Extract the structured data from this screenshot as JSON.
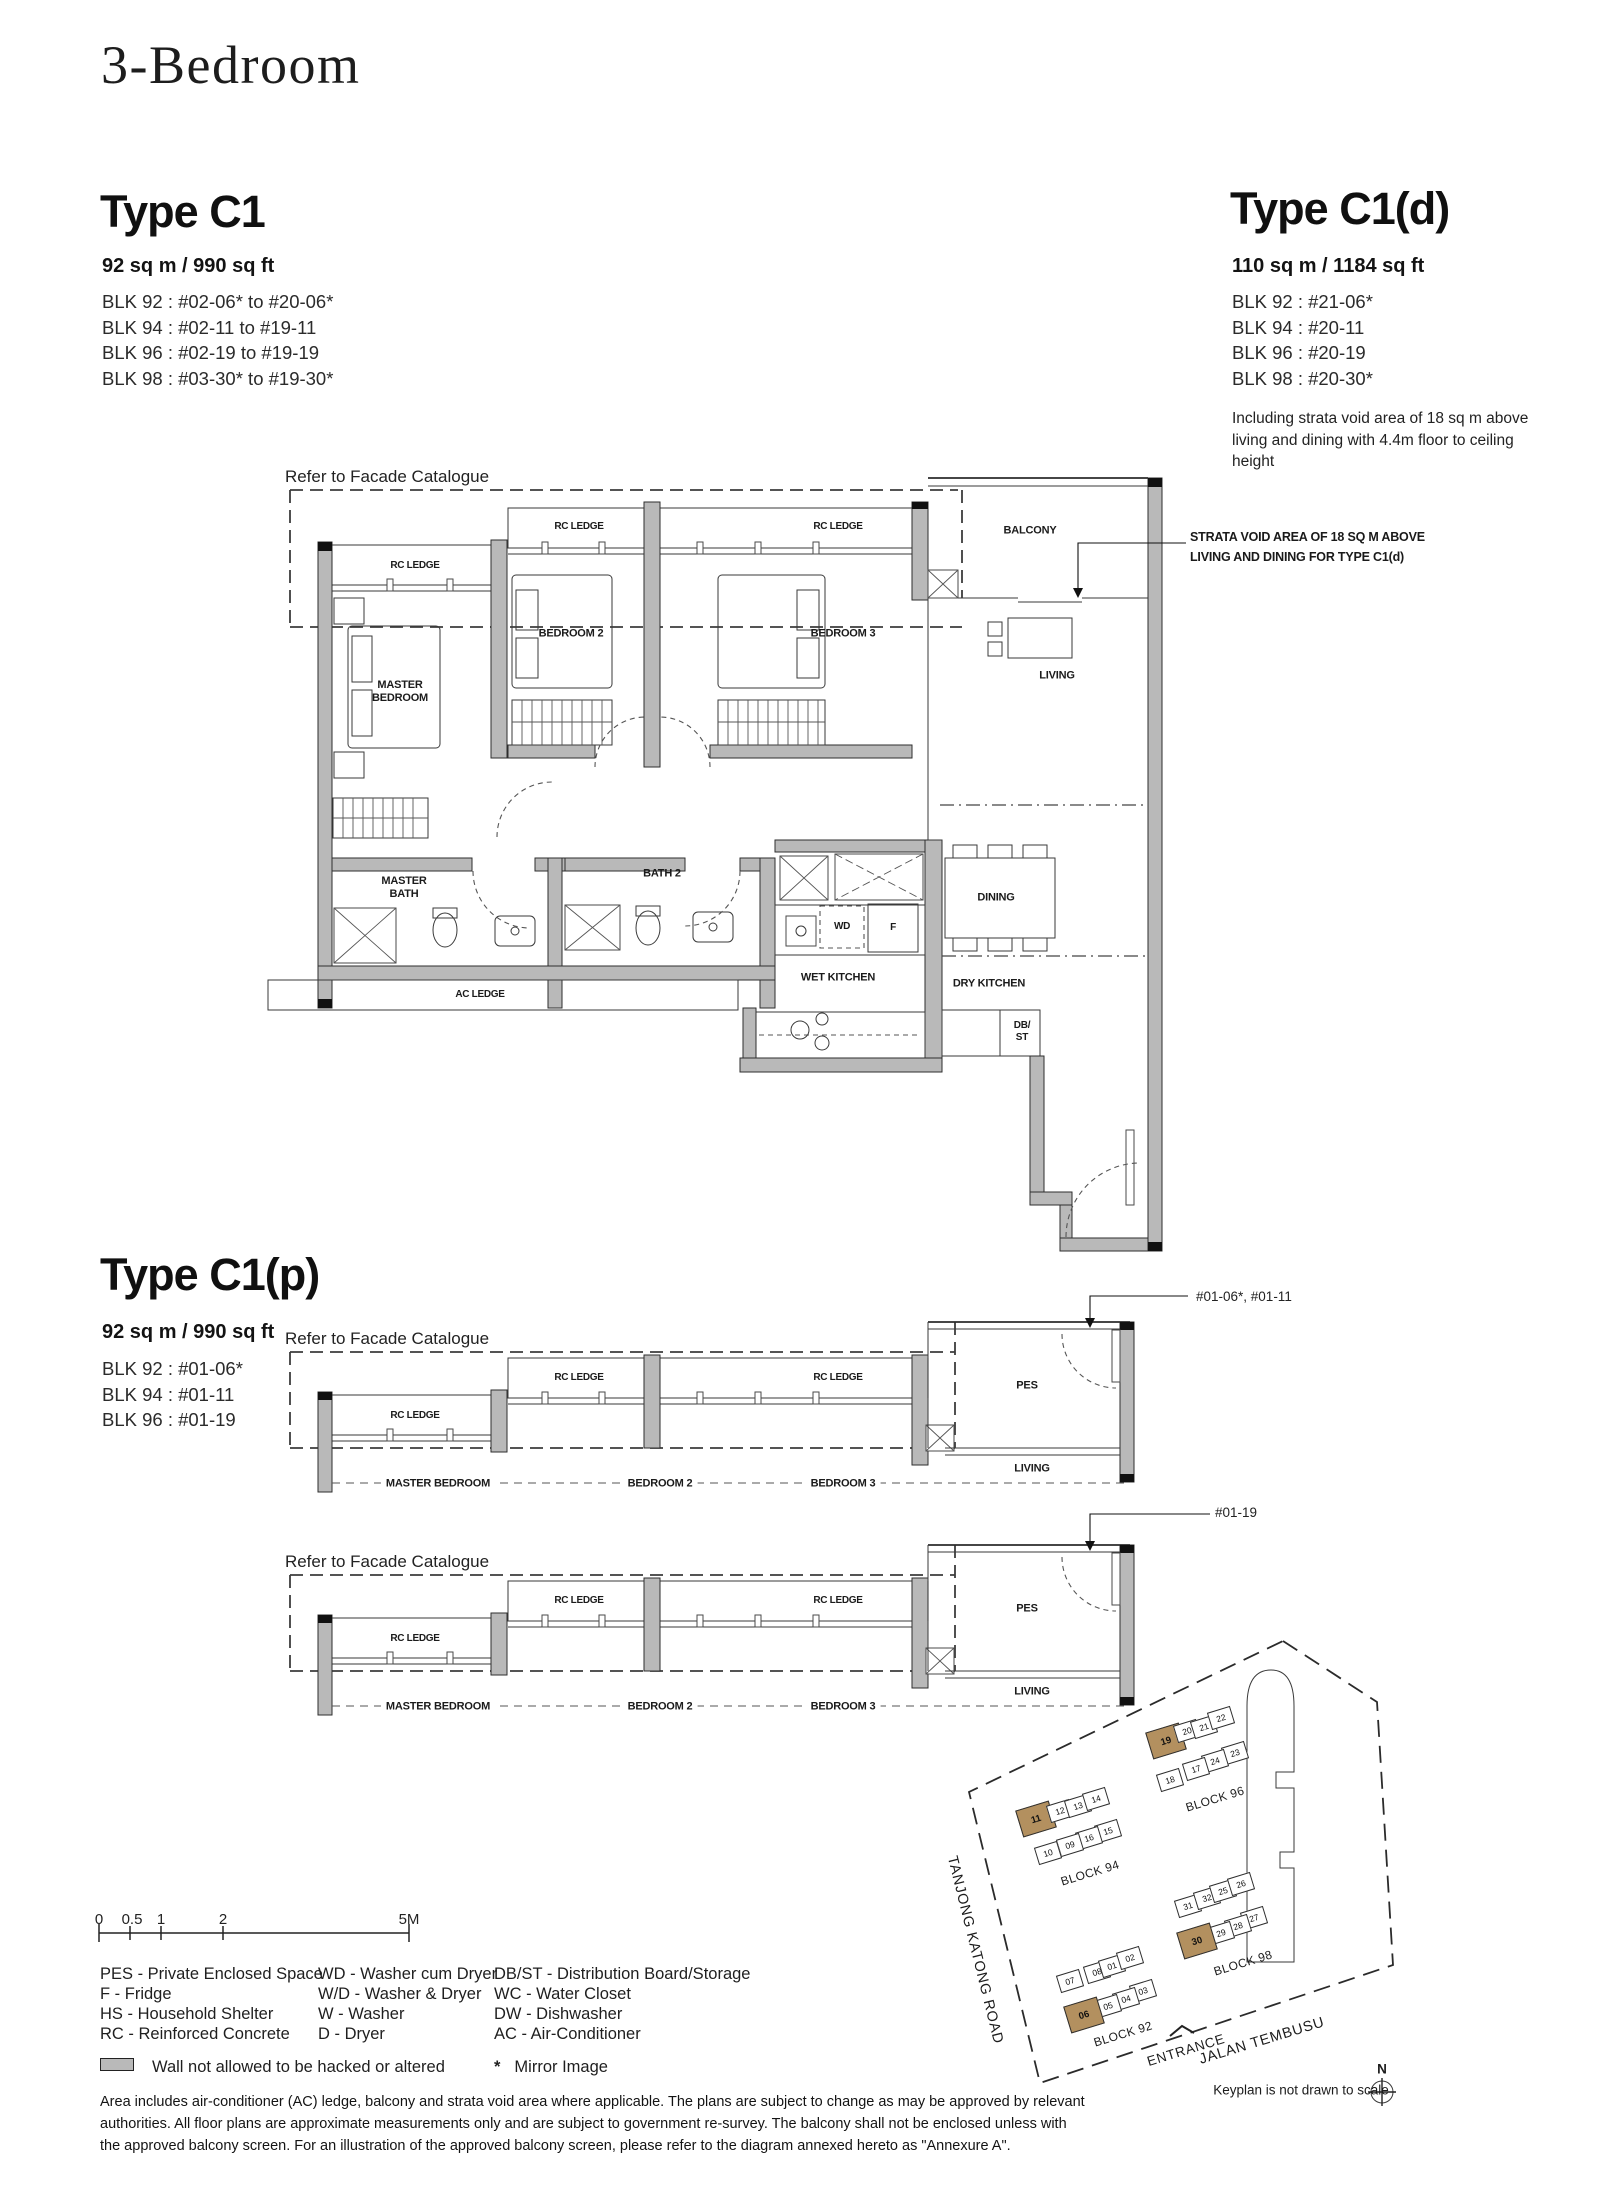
{
  "page": {
    "title": "3-Bedroom"
  },
  "type_c1": {
    "name": "Type C1",
    "area": "92 sq m / 990 sq ft",
    "blocks": [
      "BLK 92 : #02-06* to #20-06*",
      "BLK 94 : #02-11 to #19-11",
      "BLK 96 : #02-19 to #19-19",
      "BLK 98 : #03-30* to #19-30*"
    ]
  },
  "type_c1d": {
    "name": "Type C1(d)",
    "area": "110 sq m / 1184 sq ft",
    "blocks": [
      "BLK 92 : #21-06*",
      "BLK 94 : #20-11",
      "BLK 96 : #20-19",
      "BLK 98 : #20-30*"
    ],
    "note": "Including strata void area of 18 sq m above living and dining with 4.4m floor to ceiling height"
  },
  "type_c1p": {
    "name": "Type C1(p)",
    "area": "92 sq m / 990 sq ft",
    "blocks": [
      "BLK 92 : #01-06*",
      "BLK 94 : #01-11",
      "BLK 96 : #01-19"
    ]
  },
  "labels": {
    "rc_ledge": "RC LEDGE",
    "master_bedroom": "MASTER BEDROOM",
    "bedroom2": "BEDROOM 2",
    "bedroom3": "BEDROOM 3",
    "balcony": "BALCONY",
    "living": "LIVING",
    "master_bath": "MASTER BATH",
    "bath2": "BATH 2",
    "dining": "DINING",
    "wet_kitchen": "WET KITCHEN",
    "dry_kitchen": "DRY KITCHEN",
    "ac_ledge": "AC LEDGE",
    "wd": "WD",
    "f": "F",
    "db_st": "DB/\nST",
    "pes": "PES"
  },
  "annotations": {
    "facade": "Refer to Facade Catalogue",
    "strata": "STRATA VOID AREA OF 18 SQ M ABOVE\nLIVING AND DINING FOR TYPE  C1(d)",
    "units_0106": "#01-06*, #01-11",
    "unit_0119": "#01-19"
  },
  "scale_bar": {
    "ticks": [
      "0",
      "0.5",
      "1",
      "2",
      "5M"
    ]
  },
  "legend": {
    "col1": [
      "PES - Private Enclosed Space",
      "F - Fridge",
      "HS - Household Shelter",
      "RC - Reinforced Concrete"
    ],
    "col2": [
      "WD - Washer cum Dryer",
      "W/D - Washer & Dryer",
      "W - Washer",
      "D - Dryer"
    ],
    "col3": [
      "DB/ST - Distribution Board/Storage",
      "WC - Water Closet",
      "DW - Dishwasher",
      "AC - Air-Conditioner"
    ],
    "wall_note": "Wall not allowed to be hacked or altered",
    "mirror_mark": "*",
    "mirror_note": "Mirror Image"
  },
  "notes": [
    "Area includes air-conditioner (AC) ledge, balcony and strata void area where applicable. The plans are subject to change as may be approved by relevant",
    "authorities. All floor plans are approximate measurements only and are subject to government re-survey. The balcony shall not be enclosed unless with",
    "the approved balcony screen. For an illustration of the approved balcony screen, please refer to the diagram annexed hereto as \"Annexure A\"."
  ],
  "keyplan": {
    "highlight": "#b3905f",
    "roads": [
      "TANJONG KATONG ROAD",
      "JALAN TEMBUSU"
    ],
    "entrance": "ENTRANCE",
    "north": "N",
    "note": "Keyplan is not drawn to scale",
    "blocks": [
      {
        "label": "BLOCK 94",
        "units": [
          {
            "n": "11",
            "hl": true
          },
          {
            "n": "12"
          },
          {
            "n": "13"
          },
          {
            "n": "14"
          },
          {
            "n": "15"
          },
          {
            "n": "16"
          },
          {
            "n": "09"
          },
          {
            "n": "10"
          }
        ]
      },
      {
        "label": "BLOCK 96",
        "units": [
          {
            "n": "19",
            "hl": true
          },
          {
            "n": "20"
          },
          {
            "n": "21"
          },
          {
            "n": "22"
          },
          {
            "n": "23"
          },
          {
            "n": "24"
          },
          {
            "n": "17"
          },
          {
            "n": "18"
          }
        ]
      },
      {
        "label": "BLOCK 98",
        "units": [
          {
            "n": "31"
          },
          {
            "n": "32"
          },
          {
            "n": "25"
          },
          {
            "n": "26"
          },
          {
            "n": "27"
          },
          {
            "n": "28"
          },
          {
            "n": "29"
          },
          {
            "n": "30",
            "hl": true
          }
        ]
      },
      {
        "label": "BLOCK 92",
        "units": [
          {
            "n": "07"
          },
          {
            "n": "08"
          },
          {
            "n": "01"
          },
          {
            "n": "02"
          },
          {
            "n": "03"
          },
          {
            "n": "04"
          },
          {
            "n": "05"
          },
          {
            "n": "06",
            "hl": true
          }
        ]
      }
    ]
  }
}
